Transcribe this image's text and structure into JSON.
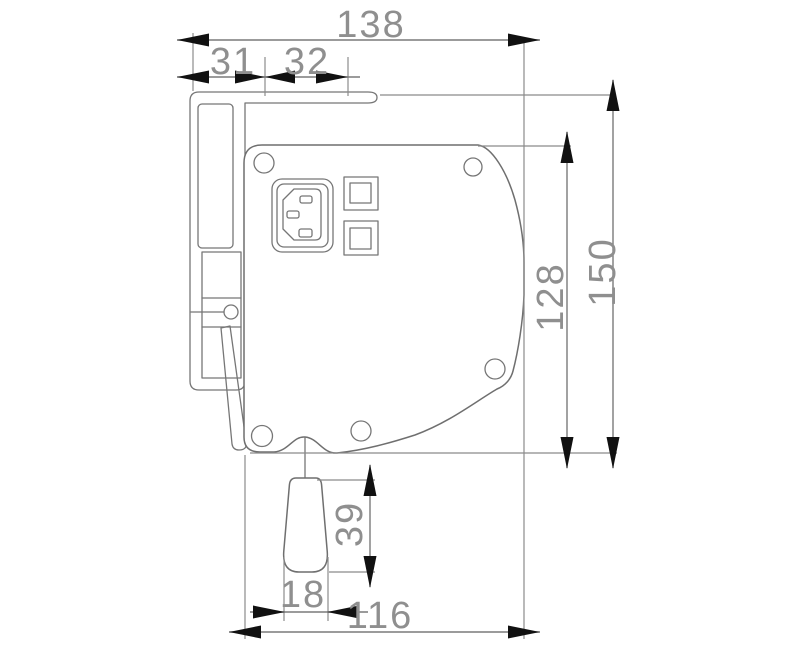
{
  "colors": {
    "background": "#ffffff",
    "outline": "#6f6f6f",
    "dimension_line": "#8b8b8b",
    "arrow": "#111111",
    "label": "#8f8f8f"
  },
  "dimensions": {
    "overall_width": {
      "label": "138",
      "orientation": "horizontal"
    },
    "left_offset": {
      "label": "31",
      "orientation": "horizontal"
    },
    "bracket_span": {
      "label": "32",
      "orientation": "horizontal"
    },
    "overall_height": {
      "label": "150",
      "orientation": "vertical"
    },
    "case_height": {
      "label": "128",
      "orientation": "vertical"
    },
    "handle_length": {
      "label": "39",
      "orientation": "vertical"
    },
    "handle_width": {
      "label": "18",
      "orientation": "horizontal"
    },
    "case_width": {
      "label": "116",
      "orientation": "horizontal"
    }
  },
  "components": [
    "wall-bracket",
    "top-flange",
    "latch-lever",
    "end-cap-body",
    "iec-power-inlet",
    "switch-button-top",
    "switch-button-bottom",
    "screw-hole",
    "pull-cord",
    "pull-handle"
  ]
}
